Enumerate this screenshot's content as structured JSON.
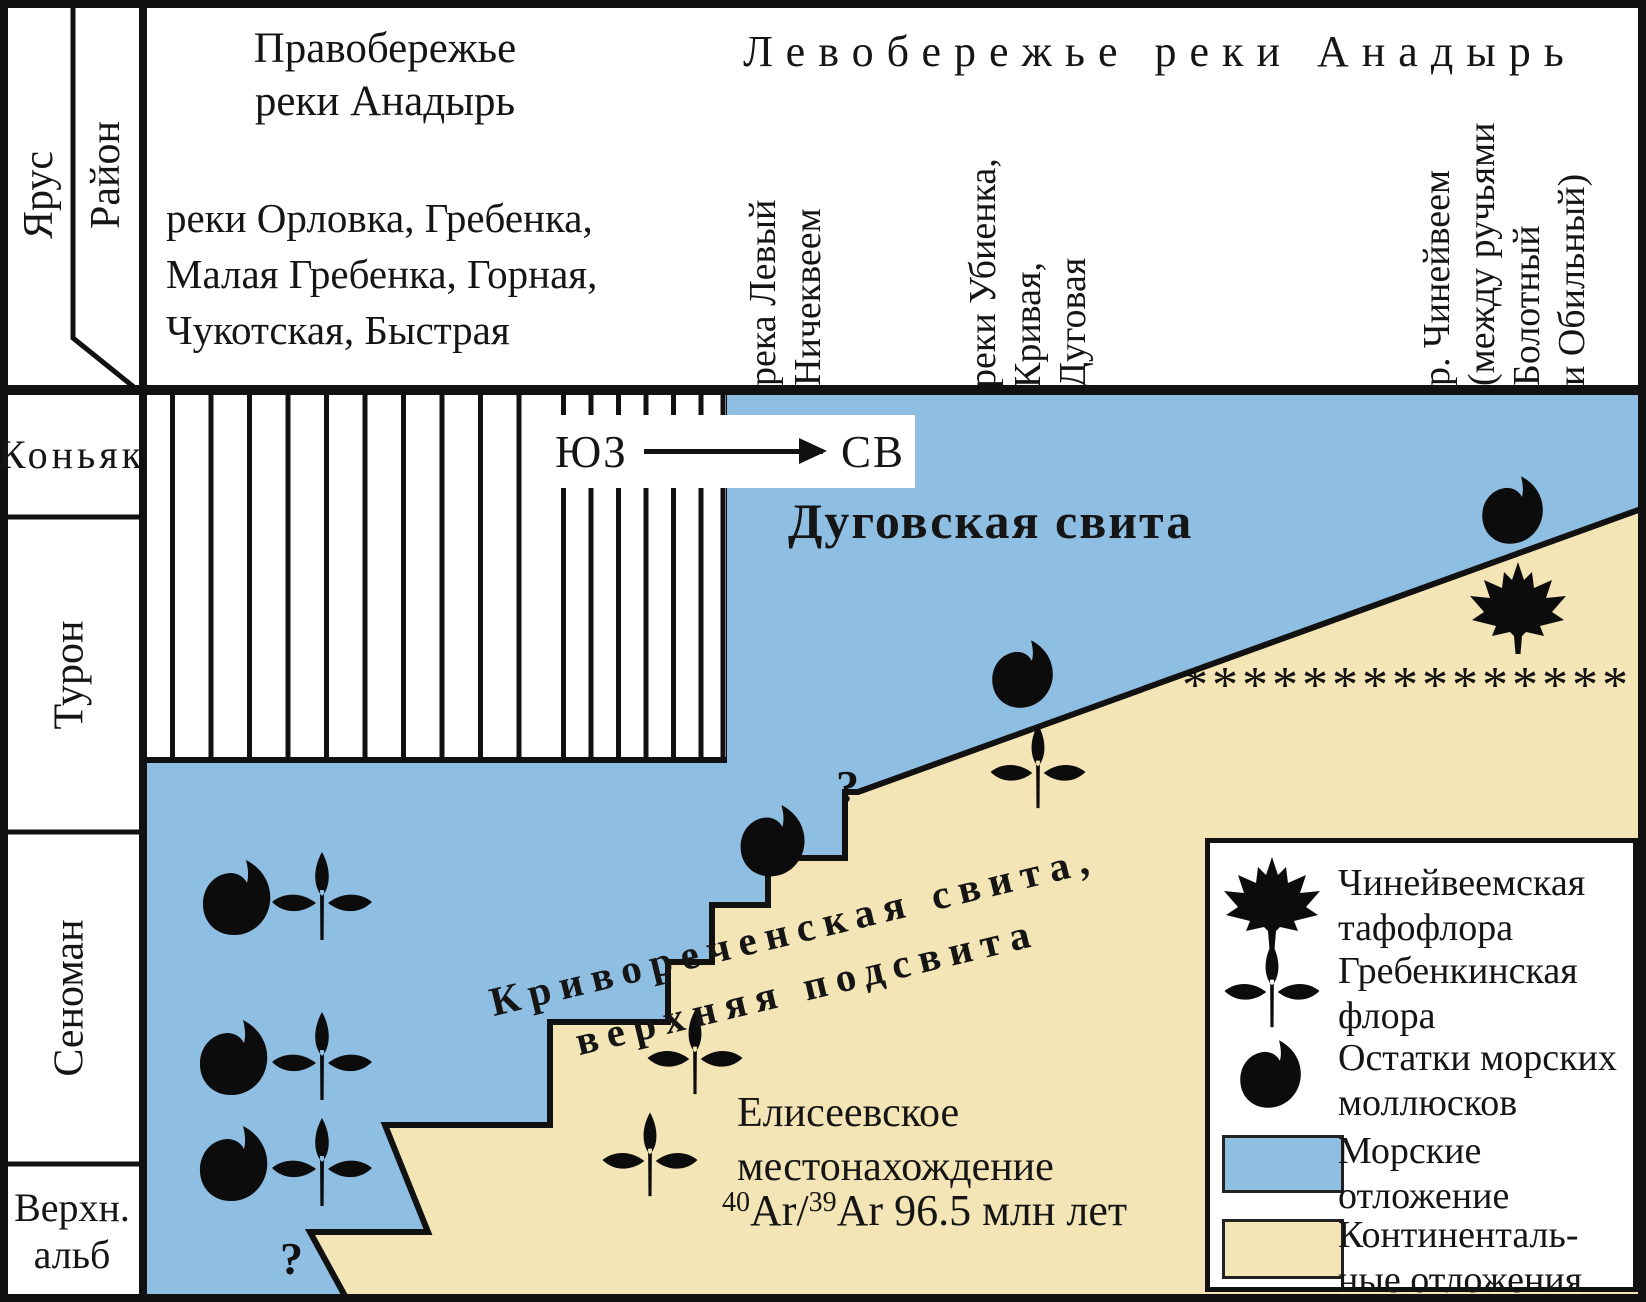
{
  "colors": {
    "marine": "#8FBEE3",
    "continental": "#F3E5B5",
    "ink": "#141414"
  },
  "header": {
    "stage_col": "Ярус",
    "region_col": "Район",
    "right_bank": {
      "title_lines": [
        "Правобережье",
        "реки Анадырь"
      ],
      "rivers_lines": [
        "реки Орловка, Гребенка,",
        "Малая Гребенка, Горная,",
        "Чукотская, Быстрая"
      ]
    },
    "left_bank": {
      "title": "Левобережье реки Анадырь",
      "col_nichekveem": [
        "река Левый",
        "Ничеквеем"
      ],
      "col_ubienka": [
        "реки Убиенка,",
        "Кривая,",
        "Дуговая"
      ],
      "col_chineyveem": [
        "р. Чинейвеем",
        "(между ручьями",
        "Болотный",
        "и Обильный)"
      ]
    }
  },
  "stages": [
    {
      "label": "Коньяк"
    },
    {
      "label": "Турон"
    },
    {
      "label": "Сеноман"
    },
    {
      "label": "Верхн.",
      "label2": "альб"
    }
  ],
  "chart": {
    "direction_from": "ЮЗ",
    "direction_to": "СВ",
    "dugovskaya_label": "Дуговская свита",
    "krivorechenskaya_line1": "Криворeченская свита,",
    "krivorechenskaya_line2": "верхняя подсвита",
    "eliseevskoe_line1": "Елисеевское",
    "eliseevskoe_line2": "местонахождение",
    "ar_sup1": "40",
    "ar_mid": "Ar/",
    "ar_sup2": "39",
    "ar_rest": "Ar 96.5 млн лет",
    "asterisks": "***************",
    "question_mark": "?",
    "question_marks": [
      {
        "x": 836,
        "y": 760
      },
      {
        "x": 280,
        "y": 1232
      }
    ]
  },
  "symbols": [
    {
      "type": "mollusk",
      "x": 236,
      "y": 902
    },
    {
      "type": "flora",
      "x": 322,
      "y": 902
    },
    {
      "type": "mollusk",
      "x": 233,
      "y": 1062
    },
    {
      "type": "flora",
      "x": 322,
      "y": 1062
    },
    {
      "type": "mollusk",
      "x": 233,
      "y": 1168
    },
    {
      "type": "flora",
      "x": 322,
      "y": 1168
    },
    {
      "type": "mollusk",
      "x": 772,
      "y": 845,
      "s": 0.95
    },
    {
      "type": "mollusk",
      "x": 1022,
      "y": 678,
      "s": 0.9
    },
    {
      "type": "flora",
      "x": 1038,
      "y": 772,
      "s": 0.95
    },
    {
      "type": "flora",
      "x": 695,
      "y": 1058,
      "s": 0.95
    },
    {
      "type": "flora",
      "x": 650,
      "y": 1160,
      "s": 0.95
    },
    {
      "type": "mollusk",
      "x": 1512,
      "y": 514,
      "s": 0.9
    },
    {
      "type": "leaf",
      "x": 1518,
      "y": 610
    }
  ],
  "legend": {
    "items": [
      {
        "icon": "leaf",
        "line1": "Чинейвеемская",
        "line2": "тафофлора"
      },
      {
        "icon": "flora",
        "line1": "Гребенкинская",
        "line2": "флора"
      },
      {
        "icon": "mollusk",
        "line1": "Остатки морских",
        "line2": "моллюсков"
      },
      {
        "icon": "marine",
        "line1": "Морские",
        "line2": "отложение"
      },
      {
        "icon": "continental",
        "line1": "Континенталь-",
        "line2": "ные отложения"
      }
    ]
  }
}
